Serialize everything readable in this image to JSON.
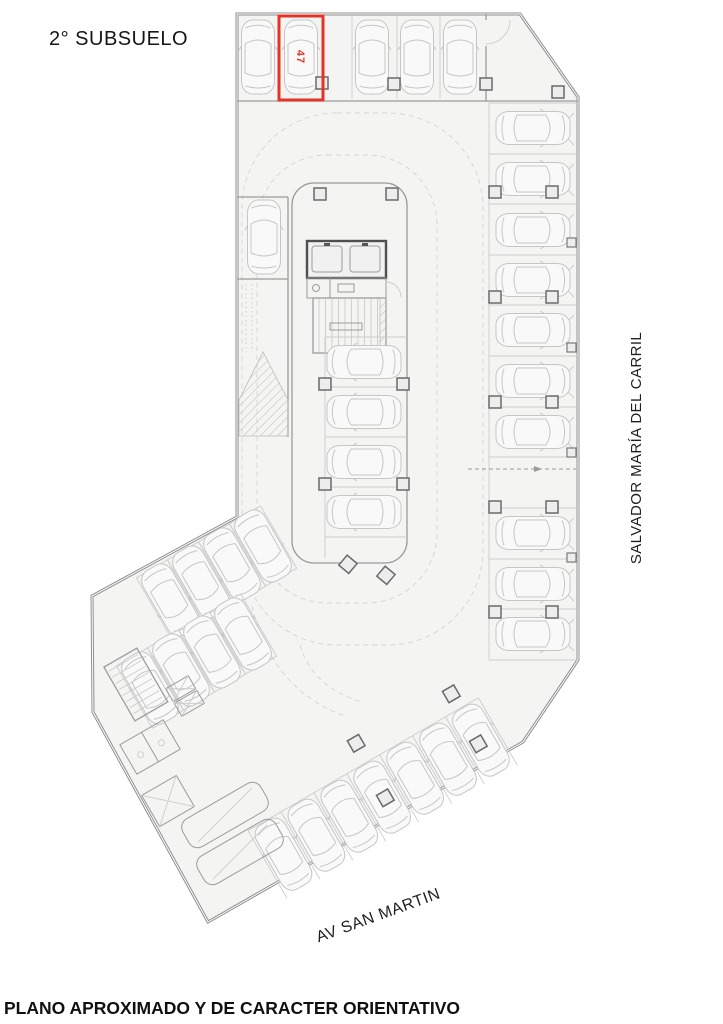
{
  "title": "2° SUBSUELO",
  "disclaimer": "PLANO APROXIMADO Y DE CARACTER ORIENTATIVO",
  "streets": {
    "right_vertical": "SALVADOR MARÍA DEL CARRIL",
    "bottom_diagonal": "AV SAN MARTIN"
  },
  "highlighted_spot": {
    "label": "47",
    "outline_color": "#e5332a",
    "location": "top row, second bay from left"
  },
  "parking": {
    "top_row_spots": 5,
    "right_column_bays": 11,
    "right_column_empty_bays": 1,
    "center_island_spots": 4,
    "bottom_row_spots": 7,
    "left_angled_spots": 8,
    "left_strip_spots": 1
  },
  "colors": {
    "highlight": "#e5332a",
    "floor": "#f4f4f3",
    "walls": "#8f8f8f",
    "car_outline": "#c6c6c6",
    "text": "#161616"
  }
}
